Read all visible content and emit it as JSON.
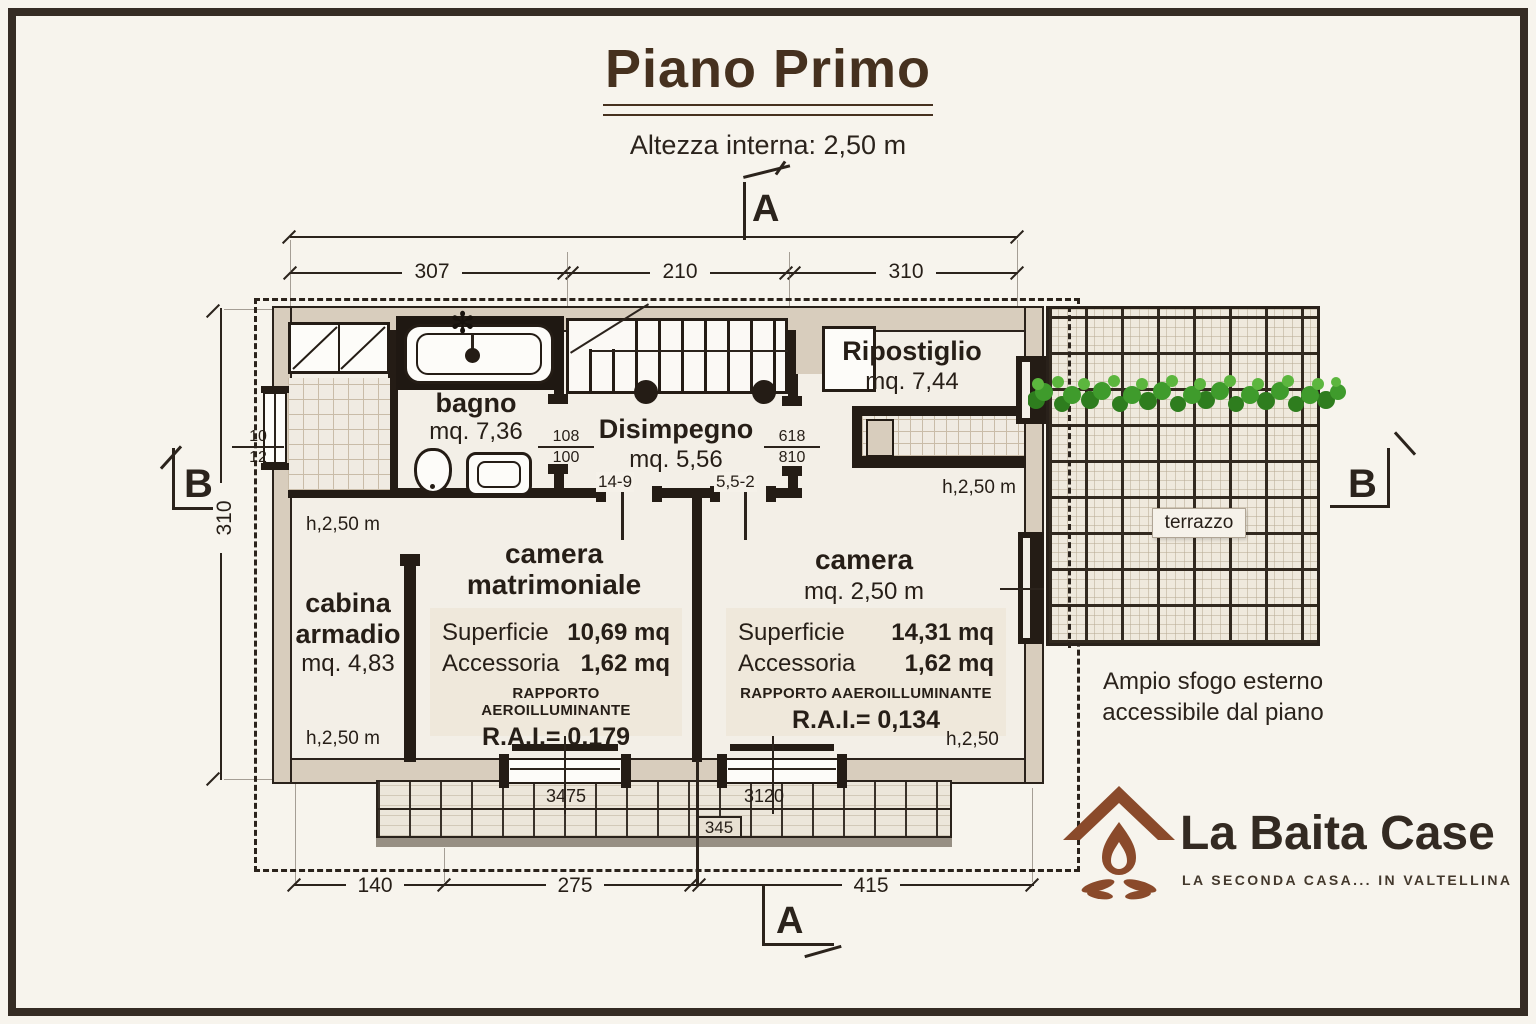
{
  "header": {
    "title": "Piano Primo",
    "subtitle": "Altezza interna: 2,50 m"
  },
  "markers": {
    "top": "A",
    "bottom": "A",
    "left": "B",
    "right": "B"
  },
  "dims": {
    "top1": "307",
    "top2": "210",
    "top3": "310",
    "bottom1": "140",
    "bottom2": "275",
    "bottom3": "415",
    "left": "310"
  },
  "rooms": {
    "bagno": {
      "name": "bagno",
      "area": "mq. 7,36"
    },
    "disimpegno": {
      "name": "Disimpegno",
      "area": "mq. 5,56"
    },
    "ripostiglio": {
      "name": "Ripostiglio",
      "area": "mq. 7,44"
    },
    "cabina": {
      "name_line1": "cabina",
      "name_line2": "armadio",
      "area": "mq. 4,83",
      "h_top": "h,2,50 m",
      "h_bottom": "h,2,50 m"
    },
    "camera_matrimoniale": {
      "name_line1": "camera",
      "name_line2": "matrimoniale",
      "superficie_label": "Superficie",
      "superficie": "10,69 mq",
      "accessoria_label": "Accessoria",
      "accessoria": "1,62 mq",
      "rapporto": "RAPPORTO AEROILLUMINANTE",
      "rai": "R.A.I.= 0,179"
    },
    "camera": {
      "name": "camera",
      "area": "mq. 2,50 m",
      "superficie_label": "Superficie",
      "superficie": "14,31 mq",
      "accessoria_label": "Accessoria",
      "accessoria": "1,62 mq",
      "rapporto": "RAPPORTO AAEROILLUMINANTE",
      "rai": "R.A.I.= 0,134",
      "h_top": "h,2,50 m",
      "h_bottom": "h,2,50"
    },
    "terrazzo": {
      "name": "terrazzo"
    }
  },
  "openings": {
    "left_window": {
      "top": "10",
      "bottom": "12"
    },
    "bagno_door": {
      "top": "108",
      "bottom": "100"
    },
    "camera_door": {
      "top": "618",
      "bottom": "810"
    },
    "door_mark_1": "14-9",
    "door_mark_2": "5,5-2",
    "window_1": "3475",
    "window_2": "3120",
    "window_3": "345"
  },
  "note": {
    "line1": "Ampio sfogo esterno",
    "line2": "accessibile dal piano"
  },
  "brand": {
    "name": "La Baita Case",
    "tagline": "LA SECONDA CASA... IN VALTELLINA"
  },
  "colors": {
    "paper": "#f7f4ed",
    "ink": "#2b231c",
    "wall_fill": "#d8cdbd",
    "plant_green": "#3f9b2c",
    "logo_brown": "#8a4a2b",
    "title_brown": "#46311f"
  }
}
